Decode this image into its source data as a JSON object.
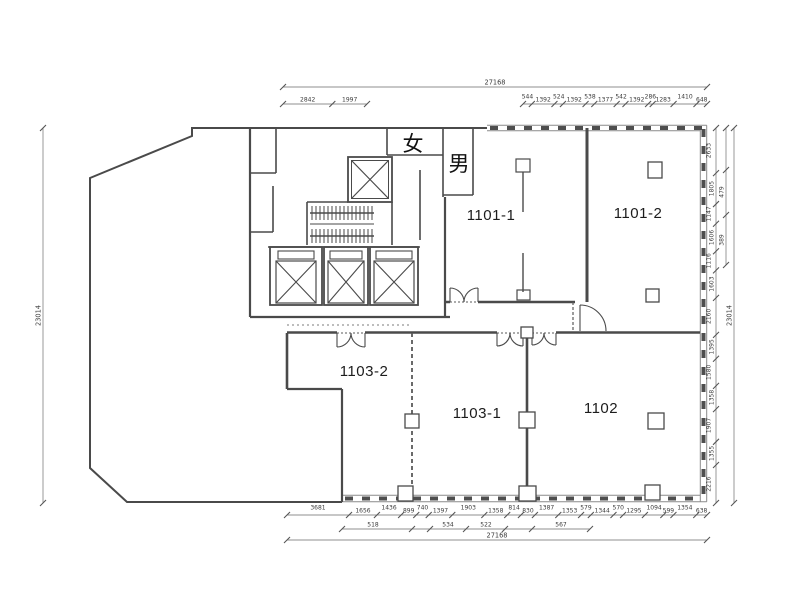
{
  "plan": {
    "rooms": [
      {
        "id": "1101-1",
        "label": "1101-1"
      },
      {
        "id": "1101-2",
        "label": "1101-2"
      },
      {
        "id": "1102",
        "label": "1102"
      },
      {
        "id": "1103-1",
        "label": "1103-1"
      },
      {
        "id": "1103-2",
        "label": "1103-2"
      }
    ],
    "restrooms": [
      {
        "id": "women",
        "label": "女"
      },
      {
        "id": "men",
        "label": "男"
      }
    ]
  },
  "dimensions": {
    "top_total": "27168",
    "top_left_segments": [
      "2842",
      "1997"
    ],
    "top_right_segments": [
      "544",
      "1392",
      "524",
      "1392",
      "538",
      "1377",
      "542",
      "1392",
      "286",
      "1283",
      "1410",
      "648"
    ],
    "bottom_segments": [
      "3681",
      "1656",
      "1436",
      "899",
      "740",
      "1397",
      "1903",
      "1358",
      "814",
      "830",
      "1387",
      "1353",
      "579",
      "1344",
      "570",
      "1295",
      "1094",
      "599",
      "1354",
      "638"
    ],
    "bottom_subtotals": [
      "518",
      "534",
      "522",
      "567"
    ],
    "bottom_total": "27168",
    "left_total": "23014",
    "right_segments": [
      "2633",
      "1805",
      "1147",
      "1606",
      "1116",
      "1603",
      "2160",
      "1395",
      "1580",
      "1358",
      "1907",
      "1355",
      "2216"
    ],
    "right_subtotals": [
      "479",
      "389"
    ],
    "right_total": "23014"
  },
  "colors": {
    "wall": "#4a4a4a",
    "window_wall": "#4e4e4e",
    "dim_line": "#8f8f8f",
    "dim_text": "#3a3a3a",
    "background": "#ffffff"
  }
}
